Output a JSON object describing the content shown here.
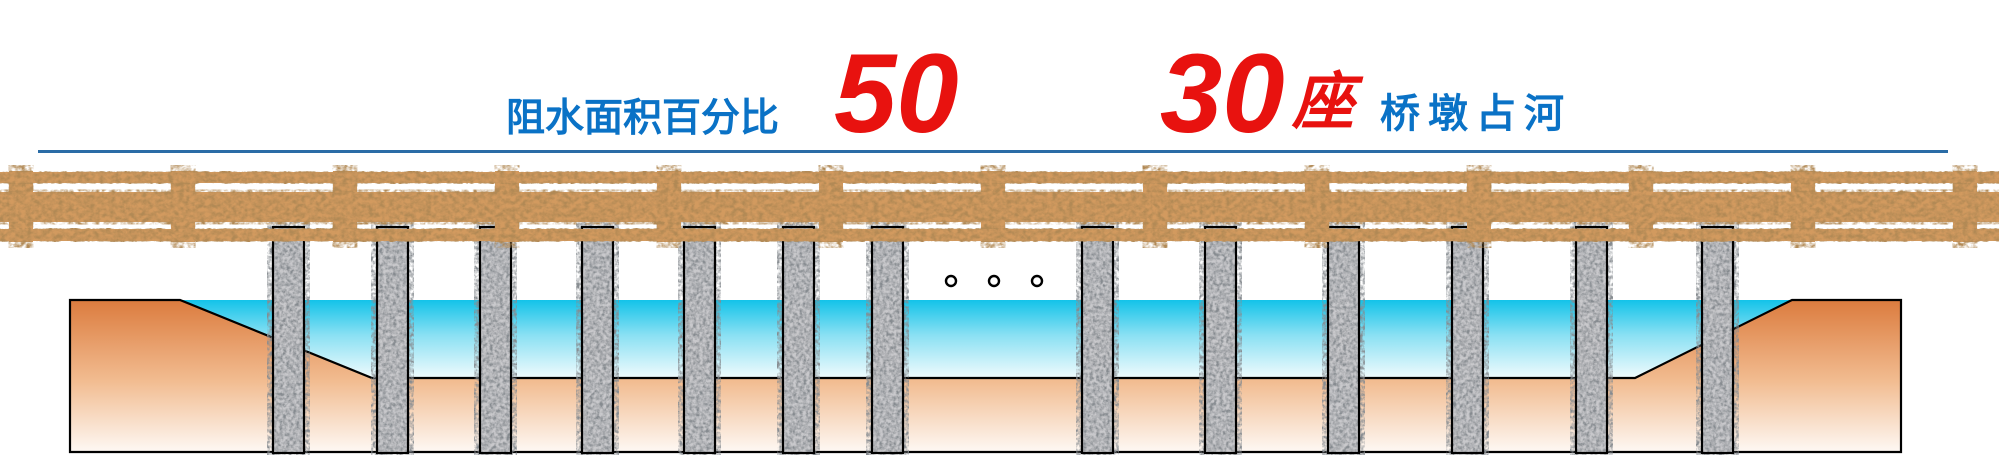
{
  "caption": {
    "blockage_label": "阻水面积百分比",
    "blockage_value": "50",
    "pier_count_value": "30",
    "pier_count_unit": "座",
    "pier_label": "桥墩占河"
  },
  "figure": {
    "pier_columns_drawn": 13,
    "ellipsis_dots": 3
  },
  "colors": {
    "label_blue": "#0a72c6",
    "value_red": "#e8120f",
    "underline_blue": "#2a6ca6",
    "water_cyan": "#13c3e9",
    "bank_orange": "#db7a3c",
    "riverbed_peach": "#f2bd92",
    "deck_cork_tan": "#d29a5f",
    "pier_granite_gray": "#c9c9cc",
    "outline_black": "#000000"
  }
}
